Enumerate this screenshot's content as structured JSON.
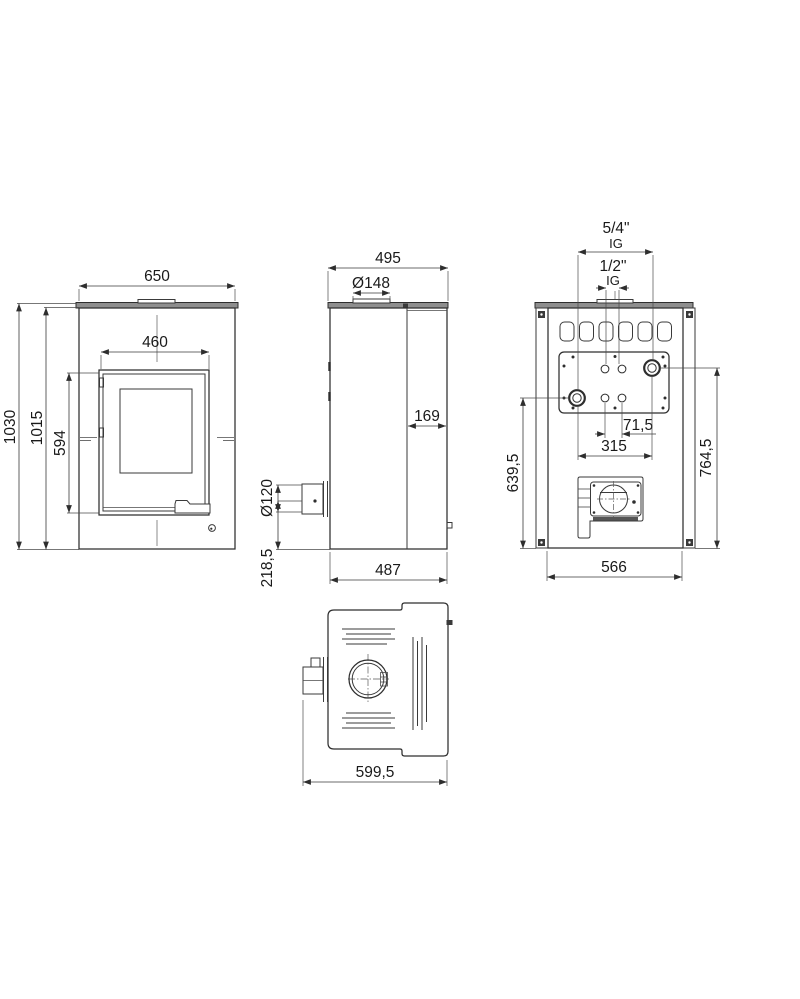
{
  "drawing": {
    "title": "Stove dimensional drawing",
    "line_color": "#2e2e2e",
    "plate_color": "#8e8e8e",
    "front": {
      "width_top": "650",
      "door_width": "460",
      "height_overall": "1030",
      "height_body": "1015",
      "door_height": "594"
    },
    "side": {
      "depth_top": "495",
      "flue_diameter": "Ø148",
      "rear_depth": "169",
      "rear_flue_diameter": "Ø120",
      "rear_flue_center_height": "218,5",
      "depth_bottom": "487"
    },
    "back": {
      "conn_large": "5/4\"",
      "conn_large_thread": "IG",
      "conn_small": "1/2\"",
      "conn_small_thread": "IG",
      "conn_small_spacing": "71,5",
      "conn_large_spacing": "315",
      "conn_height_left": "639,5",
      "conn_height_right": "764,5",
      "width_bottom": "566"
    },
    "top": {
      "depth_overall": "599,5"
    }
  }
}
